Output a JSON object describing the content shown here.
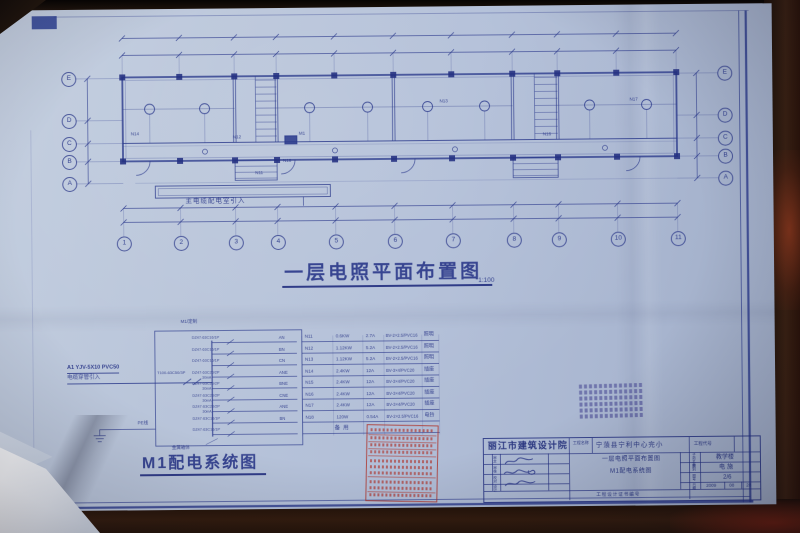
{
  "palette": {
    "paper": "#b6c2d9",
    "ink": "#2a3a8e",
    "stamp_red": "#b03228",
    "seal_purple": "#5c5c9e"
  },
  "plan": {
    "title": "一层电照平面布置图",
    "scale": "1:100",
    "incoming_note": "主电缆配电室引入",
    "axes_bottom": [
      "1",
      "2",
      "3",
      "4",
      "5",
      "6",
      "7",
      "8",
      "9",
      "10",
      "11"
    ],
    "axes_left": [
      "E",
      "D",
      "C",
      "B",
      "A"
    ],
    "axes_right": [
      "E",
      "D",
      "C",
      "B",
      "A"
    ],
    "labels": [
      "N14",
      "N12",
      "M1",
      "N11",
      "N18",
      "N13",
      "N16",
      "N17"
    ]
  },
  "system": {
    "title": "M1配电系统图",
    "box_label": "M1/定制",
    "feeder_line1": "A1 YJV-5X10 PVC50",
    "feeder_line2": "电缆穿管引入",
    "main_breaker": "T100-63C50/3P",
    "pe_label": "PE线",
    "enclosure_label": "金属箱体",
    "circuits": [
      {
        "breaker": "DZ47-63C16/1P",
        "rcd": "",
        "phase": "AN",
        "id": "N11",
        "power": "0.6KW",
        "current": "2.7A",
        "wire": "BV-2×2.5/PVC16",
        "load": "照明"
      },
      {
        "breaker": "DZ47-63C16/1P",
        "rcd": "",
        "phase": "BN",
        "id": "N12",
        "power": "1.12KW",
        "current": "5.2A",
        "wire": "BV-2×2.5/PVC16",
        "load": "照明"
      },
      {
        "breaker": "DZ47-63C16/1P",
        "rcd": "",
        "phase": "CN",
        "id": "N13",
        "power": "1.12KW",
        "current": "5.2A",
        "wire": "BV-2×2.5/PVC16",
        "load": "照明"
      },
      {
        "breaker": "DZ47-63C20/2P",
        "rcd": "30mA",
        "phase": "ANE",
        "id": "N14",
        "power": "2.4KW",
        "current": "12A",
        "wire": "BV-3×4/PVC20",
        "load": "插座"
      },
      {
        "breaker": "DZ47-63C20/2P",
        "rcd": "30mA",
        "phase": "BNE",
        "id": "N15",
        "power": "2.4KW",
        "current": "12A",
        "wire": "BV-3×4/PVC20",
        "load": "插座"
      },
      {
        "breaker": "DZ47-63C20/2P",
        "rcd": "30mA",
        "phase": "CNE",
        "id": "N16",
        "power": "2.4KW",
        "current": "12A",
        "wire": "BV-3×4/PVC20",
        "load": "插座"
      },
      {
        "breaker": "DZ47-63C20/2P",
        "rcd": "30mA",
        "phase": "ANE",
        "id": "N17",
        "power": "2.4KW",
        "current": "12A",
        "wire": "BV-3×4/PVC20",
        "load": "插座"
      },
      {
        "breaker": "DZ47-63C16/1P",
        "rcd": "",
        "phase": "BN",
        "id": "N18",
        "power": "120W",
        "current": "0.54A",
        "wire": "BV-2×2.5/PVC16",
        "load": "电铃"
      },
      {
        "breaker": "DZ47-63C16/1P",
        "rcd": "",
        "phase": "",
        "id": "",
        "power": "",
        "current": "",
        "wire": "",
        "load": "备用"
      }
    ]
  },
  "title_block": {
    "institute": "丽江市建筑设计院",
    "project_label": "工程名称",
    "project_name": "宁蒗县宁利中心完小",
    "code_label": "工程代号",
    "sign_labels": [
      "审定",
      "审核",
      "校对",
      "设计"
    ],
    "drawing_title_1": "一层电照平面布置图",
    "drawing_title_2": "M1配电系统图",
    "cert_label": "工程设计证书编号",
    "item_label": "子项名称",
    "item_value": "教学楼",
    "type_label": "图别",
    "type_value": "电施",
    "no_label": "图号",
    "no_value": "2/6",
    "date_label": "日期",
    "date_y": "2009",
    "date_m": "08",
    "date_d": "28"
  }
}
